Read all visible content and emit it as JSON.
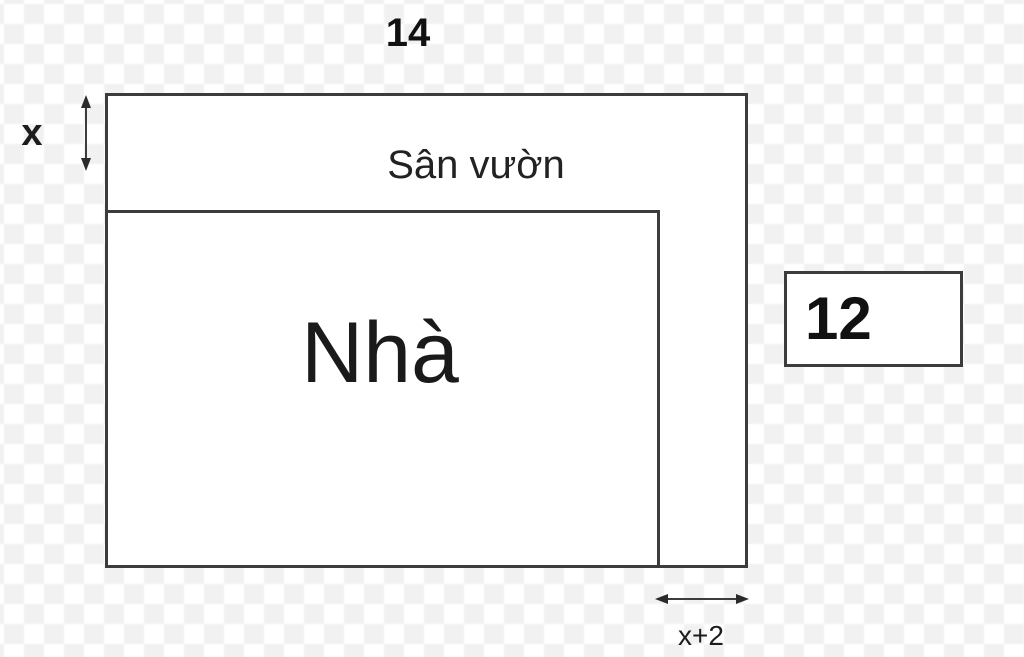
{
  "figure": {
    "labels": {
      "top_width": "14",
      "strip_height": "x",
      "garden": "Sân vườn",
      "house": "Nhà",
      "side_value": "12",
      "bottom_gap": "x+2"
    }
  },
  "icons": {
    "vertical_double_arrow": "↕",
    "horizontal_double_arrow": "↔"
  },
  "colors": {
    "line": "#3c3c3c",
    "text": "#1d1d1d",
    "checker_gray": "#f1f1f1",
    "checker_white": "#ffffff",
    "shape_fill": "#ffffff"
  }
}
